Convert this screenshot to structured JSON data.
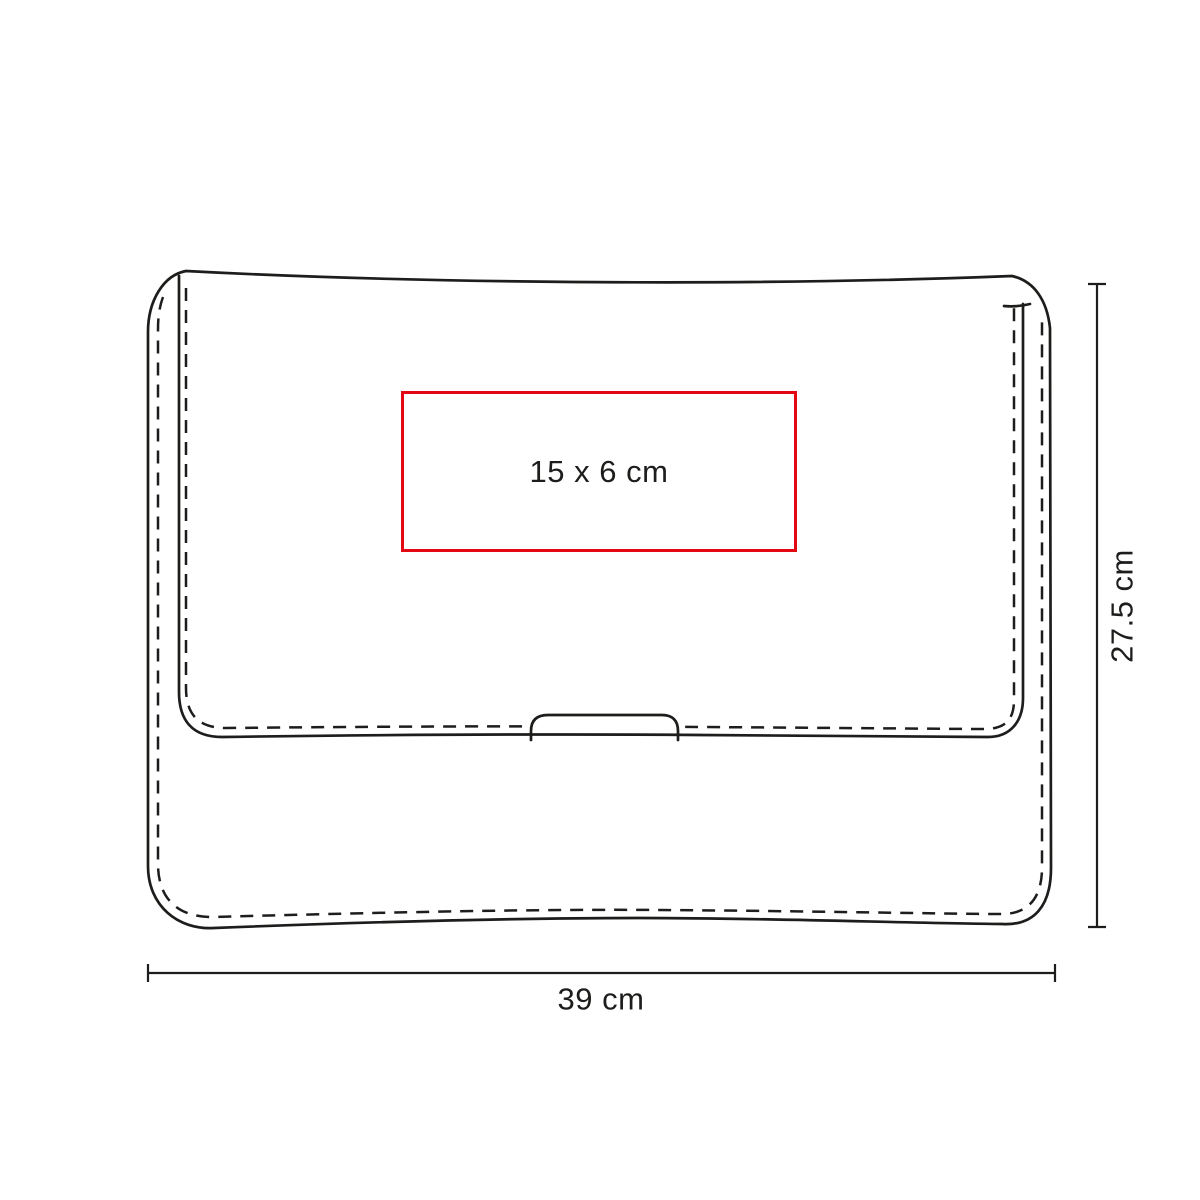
{
  "diagram": {
    "type": "product-dimension-diagram",
    "product_shape": "envelope-pouch-sleeve",
    "line_color": "#1d1d1b",
    "background_color": "#ffffff",
    "print_area": {
      "label": "15 x 6 cm",
      "border_color": "#e30613"
    },
    "dimensions": {
      "height_label": "27.5 cm",
      "width_label": "39 cm"
    }
  }
}
